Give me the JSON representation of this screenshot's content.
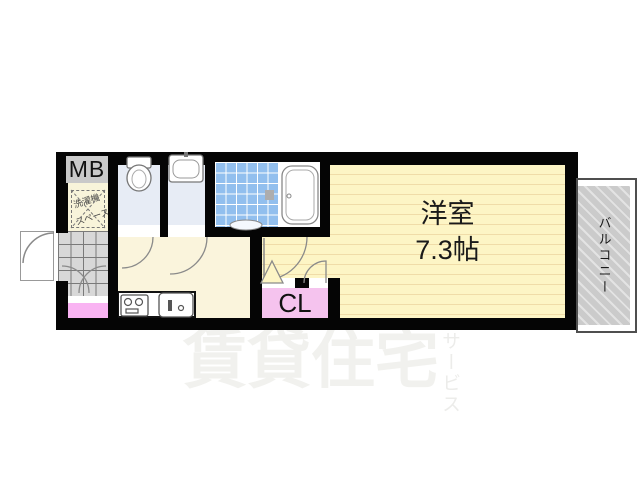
{
  "plan": {
    "labels": {
      "meter_box": "MB",
      "washer_line1": "洗濯機",
      "washer_line2": "スペース",
      "room_name": "洋室",
      "room_size": "7.3帖",
      "closet": "CL",
      "balcony": "バルコニー"
    },
    "watermark": {
      "main": "賃貸住宅",
      "sub": "サービス"
    },
    "colors": {
      "wall": "#050505",
      "main_room_floor": "#fdf5c5",
      "main_room_line": "#f0dca8",
      "hallway_floor": "#faf4dc",
      "wet_room_floor": "#e7ecf5",
      "bath_tile": "#92bfee",
      "closet_fill": "#f5c3ee",
      "entry_step_pink": "#f9b3f2",
      "entry_tile": "#d8d8d8",
      "meter_box_fill": "#c9c9c9",
      "balcony_hatch": "#cbcbcb",
      "watermark": "#f1f1ee"
    }
  }
}
